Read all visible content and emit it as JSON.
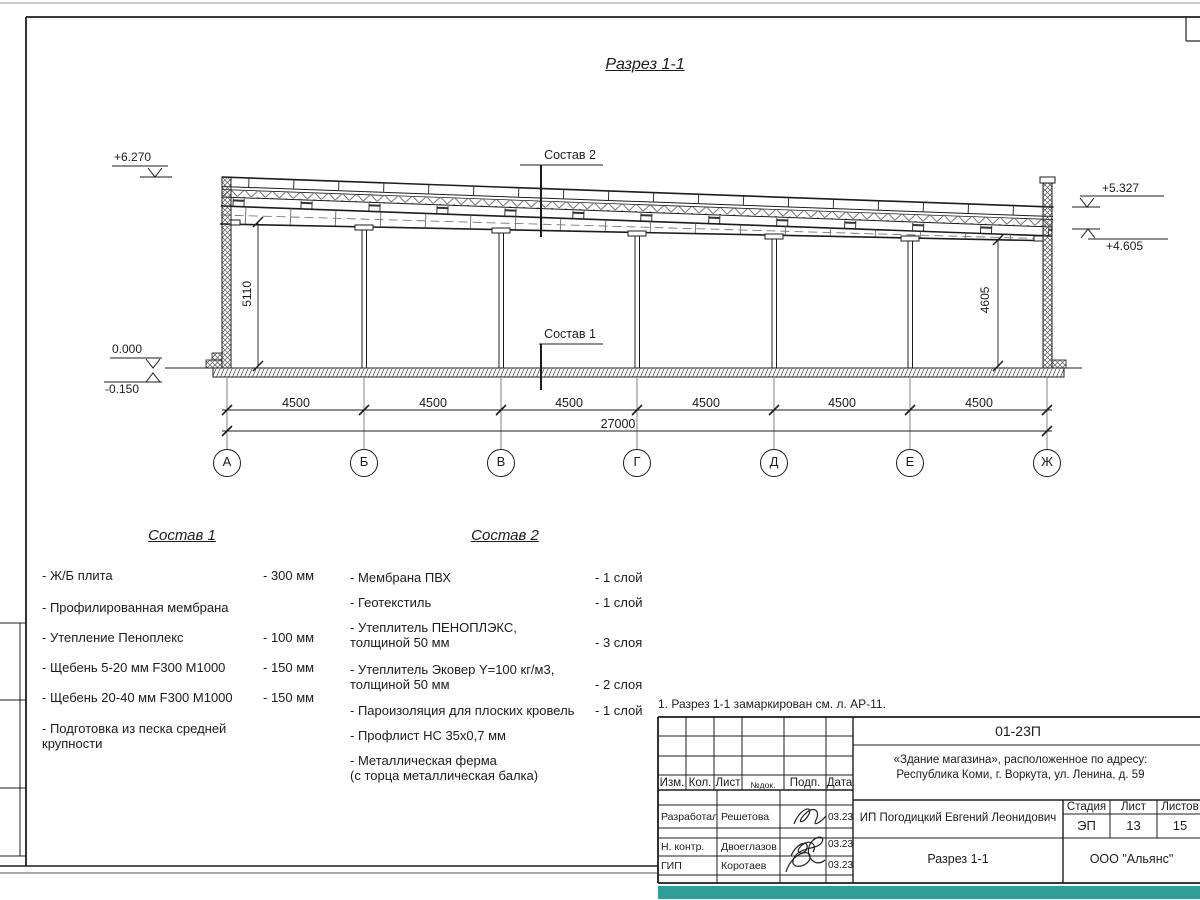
{
  "colors": {
    "stamp_strip": "#2f9e97",
    "line": "#1c1c1c"
  },
  "section": {
    "title": "Разрез 1-1",
    "labels": {
      "sostav1": "Состав 1",
      "sostav2": "Состав 2"
    },
    "elevations": {
      "left_top": "+6.270",
      "zero": "0.000",
      "below_zero": "-0.150",
      "right_roof": "+5.327",
      "right_truss": "+4.605"
    },
    "vertical_dims": {
      "left": "5110",
      "right": "4605"
    },
    "bay_dims": [
      "4500",
      "4500",
      "4500",
      "4500",
      "4500",
      "4500"
    ],
    "total_dim": "27000",
    "axes": [
      "А",
      "Б",
      "В",
      "Г",
      "Д",
      "Е",
      "Ж"
    ]
  },
  "sostav1": {
    "title": "Состав 1",
    "items": [
      {
        "name": "- Ж/Б плита",
        "value": "- 300 мм"
      },
      {
        "name": "- Профилированная мембрана",
        "value": ""
      },
      {
        "name": "- Утепление Пеноплекс",
        "value": "- 100 мм"
      },
      {
        "name": "-  Щебень 5-20 мм F300 М1000",
        "value": "- 150 мм"
      },
      {
        "name": "-  Щебень 20-40 мм F300 М1000",
        "value": "- 150 мм"
      },
      {
        "name": "- Подготовка из песка средней\nкрупности",
        "value": ""
      }
    ]
  },
  "sostav2": {
    "title": "Состав 2",
    "items": [
      {
        "name": "- Мембрана ПВХ",
        "value": "- 1 слой"
      },
      {
        "name": "- Геотекстиль",
        "value": "- 1 слой"
      },
      {
        "name": "- Утеплитель ПЕНОПЛЭКС,\nтолщиной 50 мм",
        "value": "- 3 слоя"
      },
      {
        "name": "- Утеплитель Эковер Y=100 кг/м3,\nтолщиной 50 мм",
        "value": "- 2 слоя"
      },
      {
        "name": "- Пароизоляция для плоских кровель",
        "value": "- 1 слой"
      },
      {
        "name": "- Профлист НС 35х0,7 мм",
        "value": ""
      },
      {
        "name": "- Металлическая ферма\n(с торца металлическая балка)",
        "value": ""
      }
    ]
  },
  "note": "1. Разрез 1-1 замаркирован см. л. АР-11.",
  "title_block": {
    "doc_number": "01-23П",
    "project_line1": "«Здание магазина», расположенное по адресу:",
    "project_line2": "Республика Коми, г. Воркута, ул. Ленина, д. 59",
    "header": {
      "izm": "Изм.",
      "kol": "Кол.",
      "list": "Лист",
      "ndok": "№док.",
      "podp": "Подп.",
      "data": "Дата"
    },
    "rows": [
      {
        "role": "Разработал",
        "name": "Решетова",
        "date": "03.23"
      },
      {
        "role": "Н. контр.",
        "name": "Двоеглазов",
        "date": "03.23"
      },
      {
        "role": "ГИП",
        "name": "Коротаев",
        "date": "03.23"
      }
    ],
    "client": "ИП Погодицкий Евгений Леонидович",
    "stage_label": "Стадия",
    "sheet_label": "Лист",
    "sheets_label": "Листов",
    "stage": "ЭП",
    "sheet_no": "13",
    "sheets_total": "15",
    "drawing_name": "Разрез 1-1",
    "company": "ООО \"Альянс\""
  }
}
